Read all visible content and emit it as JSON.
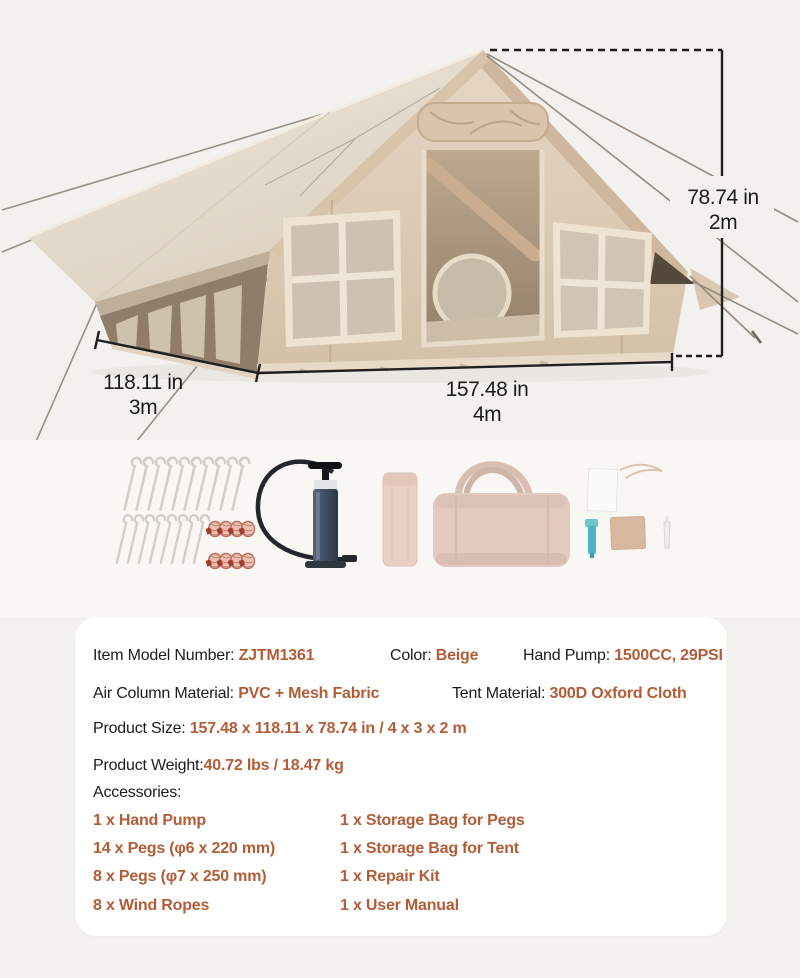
{
  "dimensions": {
    "height_in": "78.74 in",
    "height_m": "2m",
    "depth_in": "118.11 in",
    "depth_m": "3m",
    "width_in": "157.48 in",
    "width_m": "4m"
  },
  "specs": {
    "item_model_label": "Item Model Number: ",
    "item_model_value": "ZJTM1361",
    "color_label": "Color: ",
    "color_value": "Beige",
    "hand_pump_label": "Hand Pump: ",
    "hand_pump_value": "1500CC, 29PSI",
    "air_column_label": "Air Column Material: ",
    "air_column_value": "PVC + Mesh Fabric",
    "tent_material_label": "Tent Material: ",
    "tent_material_value": "300D Oxford Cloth",
    "product_size_label": "Product Size: ",
    "product_size_value": "157.48 x 118.11 x 78.74 in / 4 x 3 x 2 m",
    "product_weight_label": "Product Weight:",
    "product_weight_value": "40.72 lbs / 18.47 kg",
    "accessories_label": "Accessories:"
  },
  "accessories": {
    "col1": [
      "1 x Hand Pump",
      "14 x Pegs (φ6 x 220 mm)",
      "8 x Pegs (φ7 x 250 mm)",
      "8 x Wind Ropes"
    ],
    "col2": [
      "1 x Storage Bag for Pegs",
      "1 x Storage Bag for Tent",
      "1 x Repair Kit",
      "1 x User Manual"
    ]
  },
  "colors": {
    "accent": "#b25c38",
    "text": "#1c1c1c",
    "panel_bg": "#ffffff",
    "page_bg": "#f3f2ee",
    "canvas_beige": "#dccab4"
  }
}
